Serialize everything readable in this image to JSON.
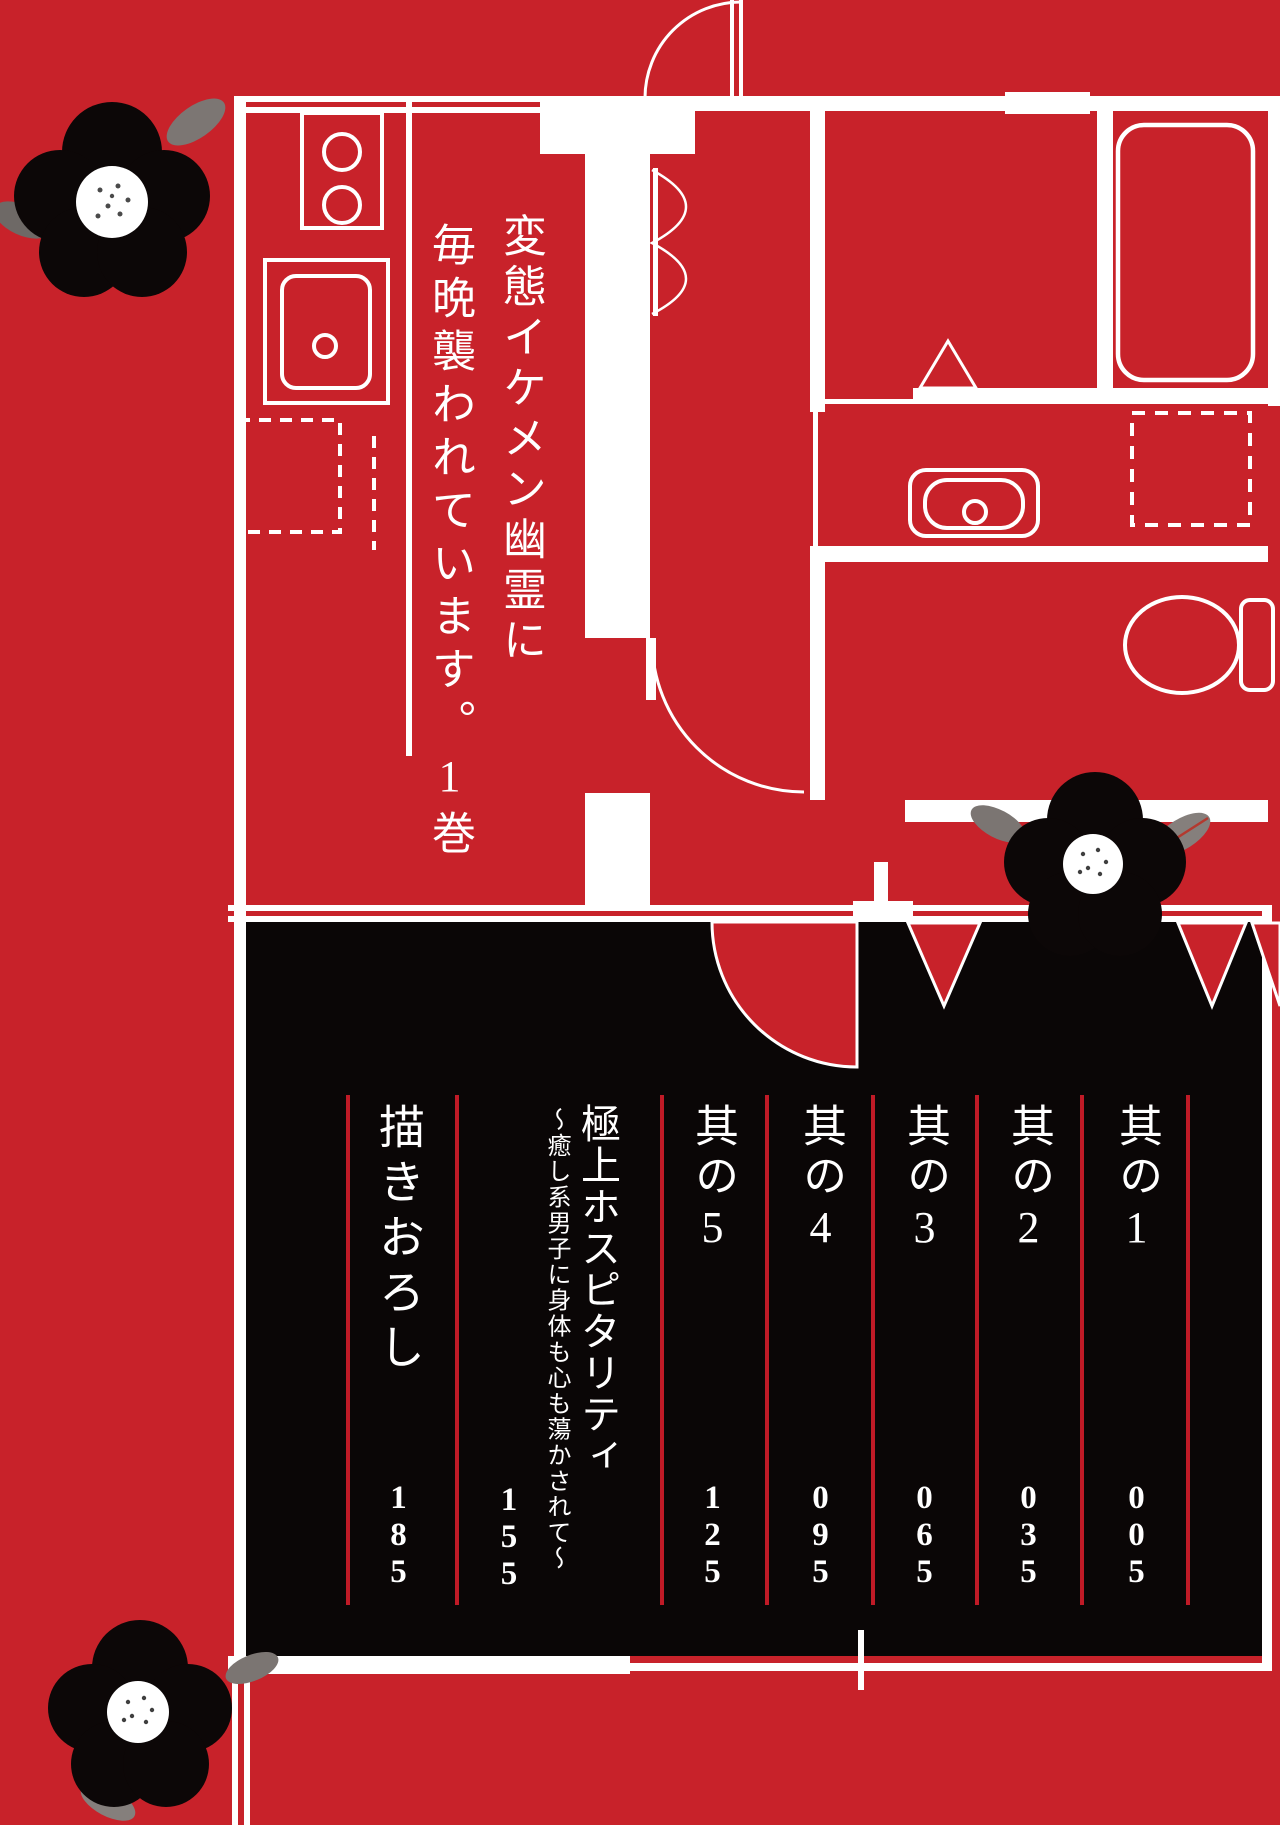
{
  "book_title": {
    "lines": [
      "変態イケメン幽霊に",
      "毎晩襲われています。1巻"
    ]
  },
  "toc": {
    "entries": [
      {
        "label": "其の1",
        "page": "005"
      },
      {
        "label": "其の2",
        "page": "035"
      },
      {
        "label": "其の3",
        "page": "065"
      },
      {
        "label": "其の4",
        "page": "095"
      },
      {
        "label": "其の5",
        "page": "125"
      },
      {
        "label": "極上ホスピタリティ",
        "subtitle": "～癒し系男子に身体も心も蕩かされて～",
        "page": "155"
      },
      {
        "label": "描きおろし",
        "page": "185"
      }
    ]
  },
  "colors": {
    "background_red": "#c8222a",
    "contents_black": "#0a0606",
    "line_white": "#ffffff",
    "separator_red": "#bf1a26",
    "leaf_gray": "#847e7b",
    "leaf_vein_red": "#b3392f"
  },
  "decorations": {
    "flower_icon": "camellia-flower-icon",
    "plan_icon": "apartment-floor-plan"
  }
}
